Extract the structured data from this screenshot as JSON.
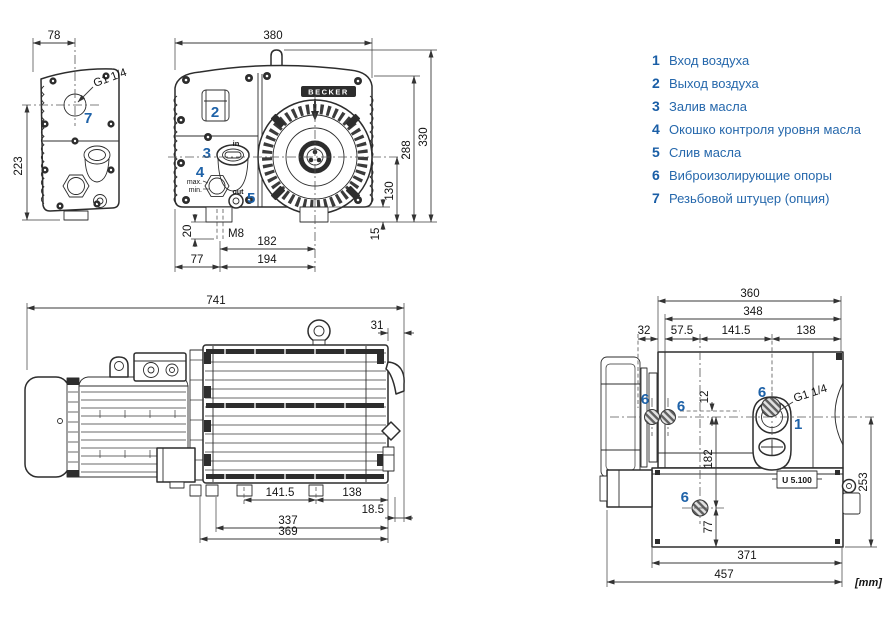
{
  "unit_note": "[mm]",
  "colors": {
    "accent_blue": "#1e62a8",
    "line": "#2d2d2d"
  },
  "legend": {
    "items": [
      {
        "num": "1",
        "label": "Вход воздуха"
      },
      {
        "num": "2",
        "label": "Выход воздуха"
      },
      {
        "num": "3",
        "label": "Залив масла"
      },
      {
        "num": "4",
        "label": "Окошко контроля уровня масла"
      },
      {
        "num": "5",
        "label": "Слив масла"
      },
      {
        "num": "6",
        "label": "Виброизолирующие опоры"
      },
      {
        "num": "7",
        "label": "Резьбовой штуцер (опция)"
      }
    ]
  },
  "views": {
    "side_plate": {
      "dims": {
        "width": "78",
        "height": "223",
        "port_thread": "G1 1/4"
      },
      "callouts": {
        "threaded_port": "7"
      }
    },
    "front": {
      "logo": "BECKER",
      "dims": {
        "width": "380",
        "height_total": "330",
        "height_housing": "288",
        "fan_center_height": "130",
        "foot_height": "15",
        "stud_depth": "20",
        "stud_thread": "M8",
        "stud_span": "182",
        "left_offset": "77",
        "foot_span": "194"
      },
      "callouts": {
        "air_outlet": "2",
        "oil_fill": "3",
        "oil_window": "4",
        "oil_drain": "5"
      },
      "port_labels": {
        "in": "in",
        "out": "out",
        "max": "max.",
        "min": "min."
      }
    },
    "side": {
      "dims": {
        "total_length": "741",
        "rear_offset": "31",
        "foot_span_a": "141.5",
        "foot_span_b": "138",
        "rear_foot_offset": "18.5",
        "foot_span_total": "337",
        "base_length": "369"
      }
    },
    "top": {
      "nameplate": "U 5.100",
      "dims": {
        "width_total": "360",
        "width_body": "348",
        "motor_gap": "32",
        "offset_a": "57.5",
        "span_a": "141.5",
        "span_b": "138",
        "inlet_offset": "12",
        "inlet_to_mount": "182",
        "mount_offset": "77",
        "depth": "253",
        "base_length": "371",
        "total_length": "457",
        "port_thread": "G1 1/4"
      },
      "callouts": {
        "air_inlet": "1",
        "mount_a": "6",
        "mount_b": "6",
        "mount_c": "6",
        "mount_d": "6"
      }
    }
  }
}
